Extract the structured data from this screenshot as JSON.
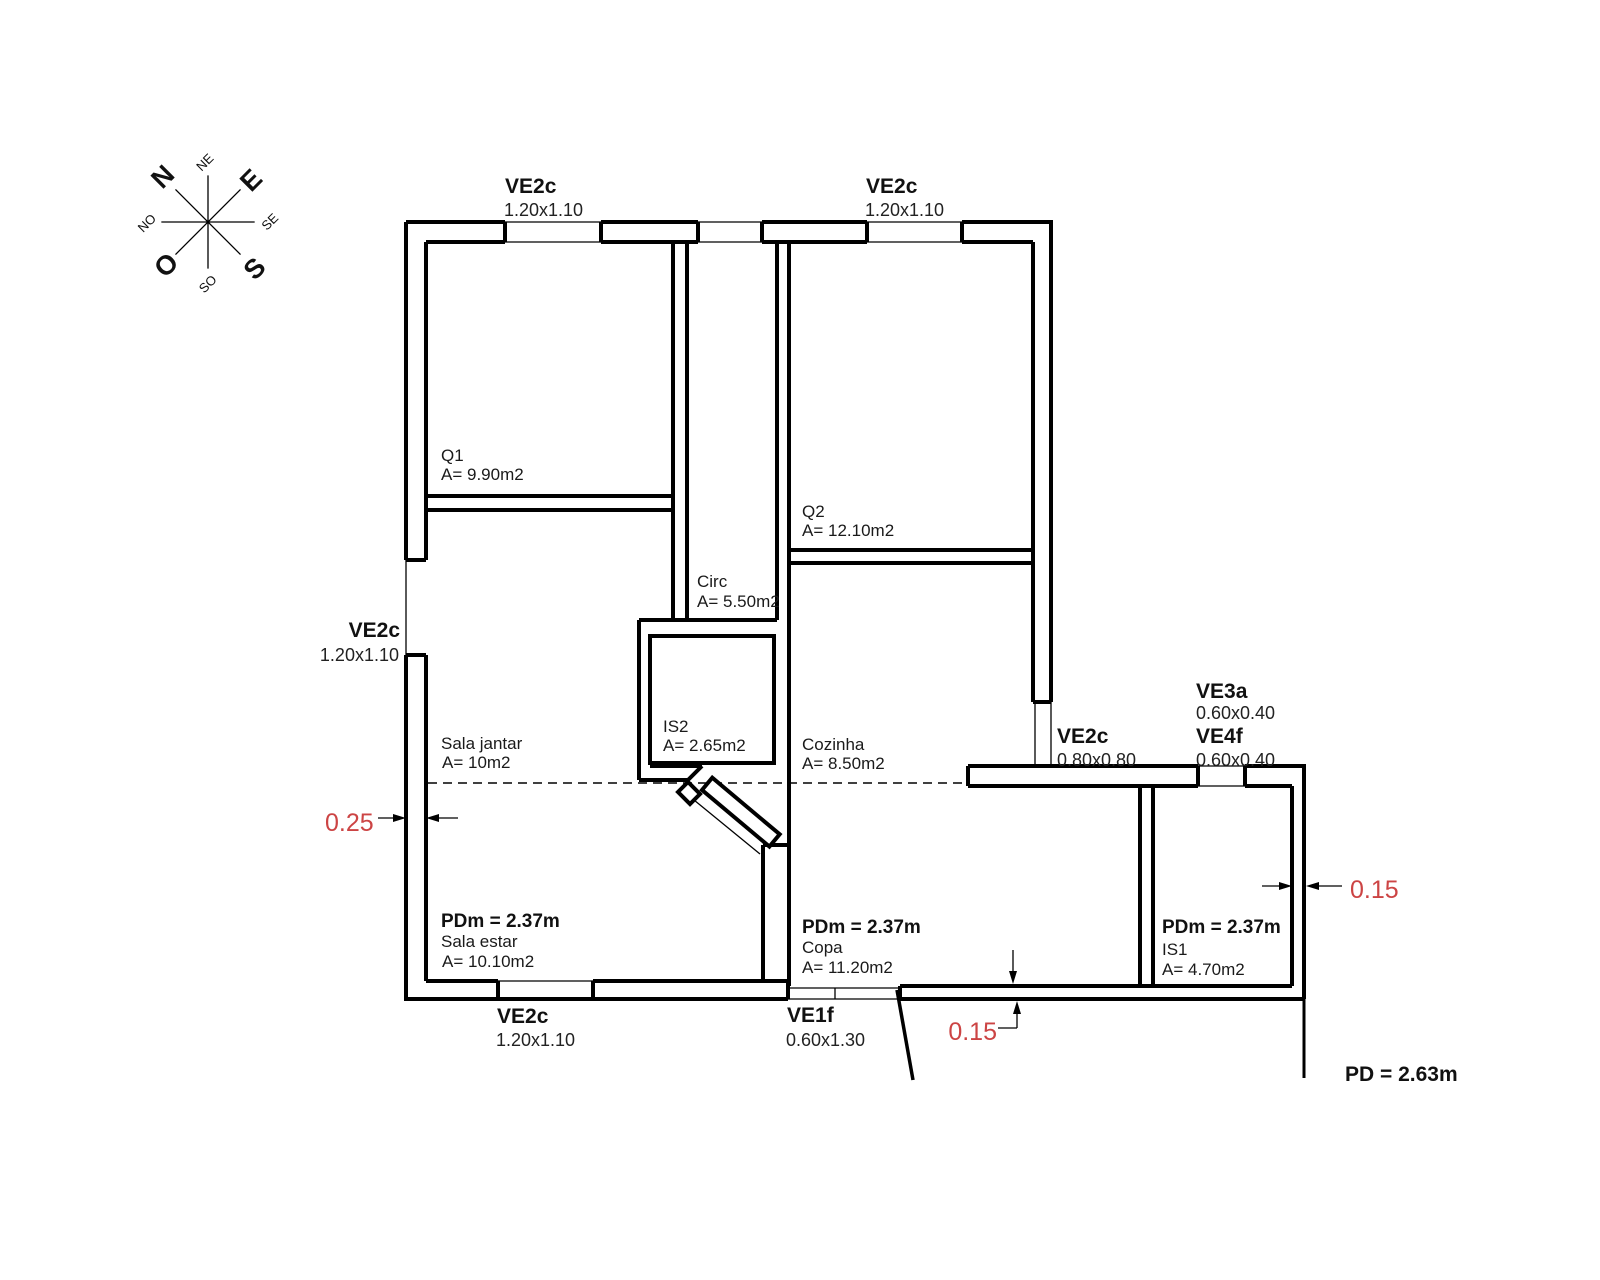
{
  "compass": {
    "n": "N",
    "e": "E",
    "s": "S",
    "o": "O",
    "ne": "NE",
    "se": "SE",
    "so": "SO",
    "no": "NO"
  },
  "windows": {
    "top_left": {
      "name": "VE2c",
      "size": "1.20x1.10"
    },
    "top_right": {
      "name": "VE2c",
      "size": "1.20x1.10"
    },
    "left": {
      "name": "VE2c",
      "size": "1.20x1.10"
    },
    "bottom": {
      "name": "VE2c",
      "size": "1.20x1.10"
    },
    "entry": {
      "name": "VE1f",
      "size": "0.60x1.30"
    },
    "kitchen": {
      "name": "VE2c",
      "size": "0.80x0.80"
    },
    "bath_high": {
      "name": "VE3a",
      "size": "0.60x0.40"
    },
    "bath": {
      "name": "VE4f",
      "size": "0.60x0.40"
    }
  },
  "rooms": {
    "q1": {
      "name": "Q1",
      "area": "A= 9.90m2"
    },
    "q2": {
      "name": "Q2",
      "area": "A= 12.10m2"
    },
    "circ": {
      "name": "Circ",
      "area": "A= 5.50m2"
    },
    "is2": {
      "name": "IS2",
      "area": "A= 2.65m2"
    },
    "cozinha": {
      "name": "Cozinha",
      "area": "A= 8.50m2"
    },
    "sala_jantar": {
      "name": "Sala jantar",
      "area": "A= 10m2"
    },
    "sala_estar": {
      "name": "Sala estar",
      "area": "A= 10.10m2",
      "ceiling": "PDm = 2.37m"
    },
    "copa": {
      "name": "Copa",
      "area": "A= 11.20m2",
      "ceiling": "PDm = 2.37m"
    },
    "is1": {
      "name": "IS1",
      "area": "A= 4.70m2",
      "ceiling": "PDm = 2.37m"
    }
  },
  "dimensions": {
    "left_wall": "0.25",
    "right_wall": "0.15",
    "bottom_wall": "0.15"
  },
  "notes": {
    "ceiling_height": "PD = 2.63m"
  },
  "colors": {
    "dimension_red": "#cc4444",
    "line": "#000000",
    "background": "#ffffff"
  }
}
